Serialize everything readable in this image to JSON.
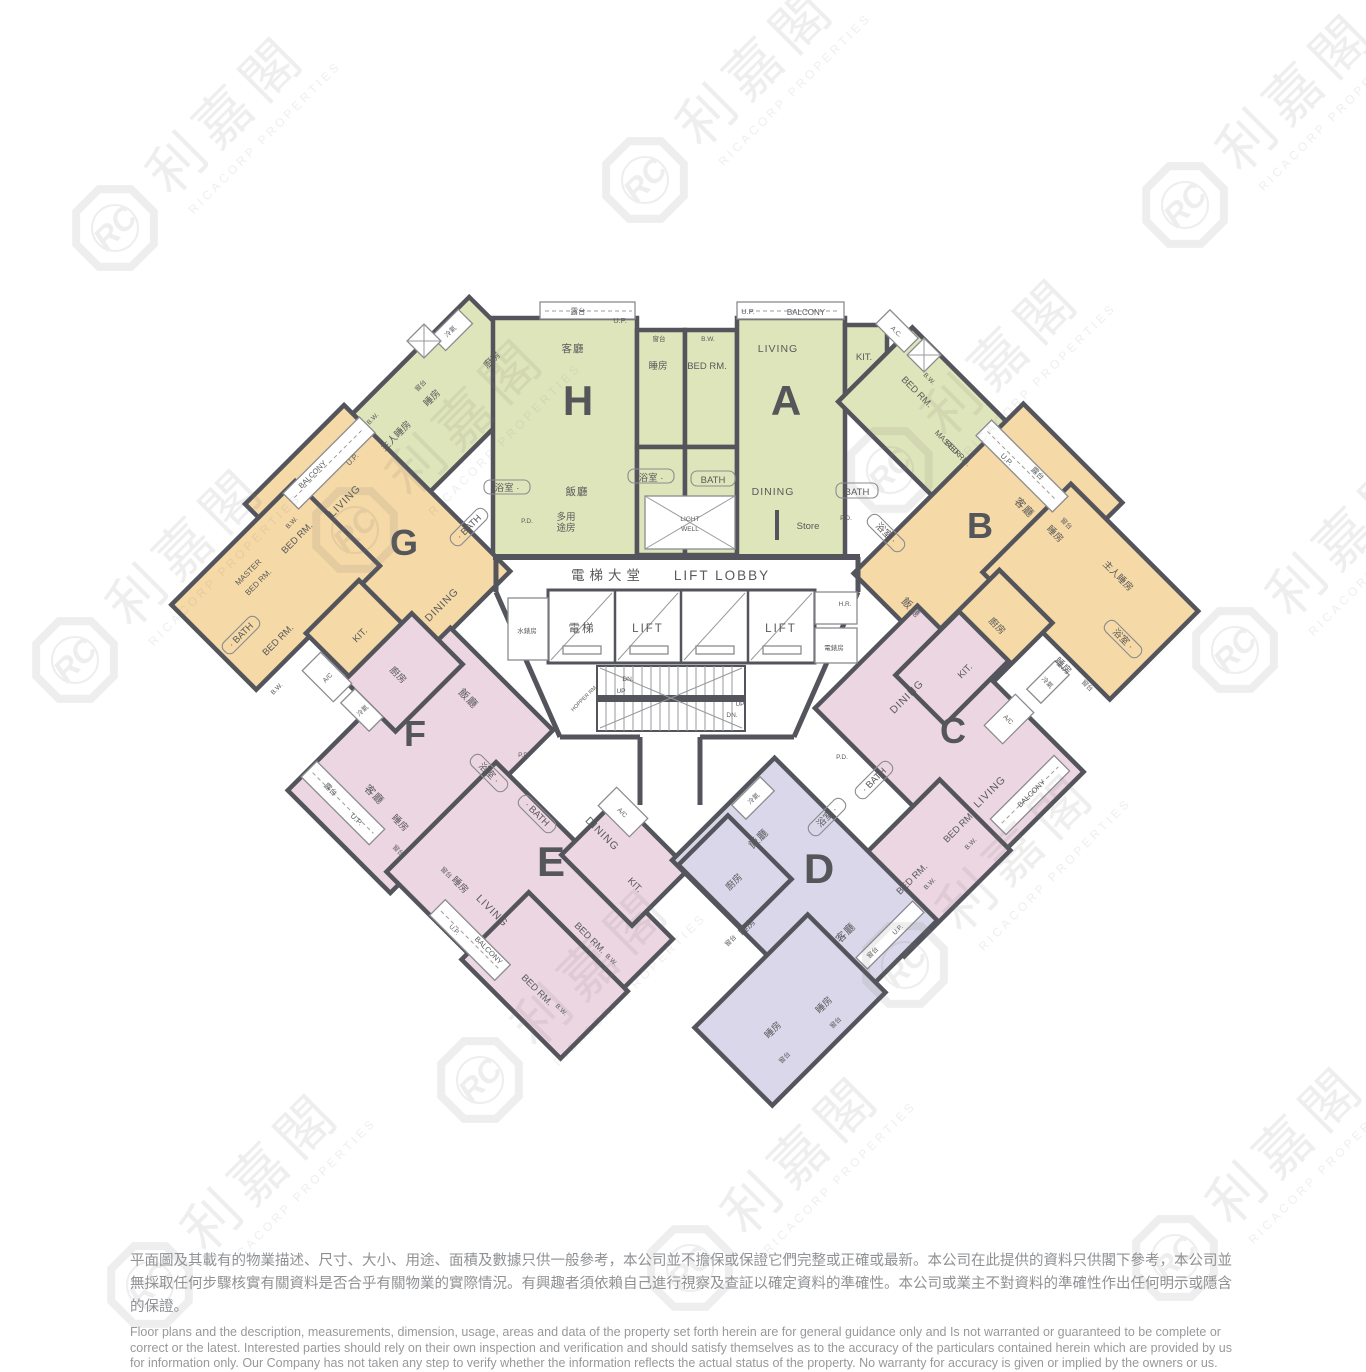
{
  "watermark": {
    "zh": "利嘉閣",
    "en": "RICACORP PROPERTIES",
    "monogram": "RC"
  },
  "units": {
    "a": "A",
    "b": "B",
    "c": "C",
    "d": "D",
    "e": "E",
    "f": "F",
    "g": "G",
    "h": "H"
  },
  "labels": {
    "balcony_zh": "露台",
    "balcony_en": "BALCONY",
    "up": "U.P.",
    "bw": "B.W.",
    "bay_zh": "窗台",
    "living_zh": "客廳",
    "living_en": "LIVING",
    "dining_zh": "飯廳",
    "dining_en": "DINING",
    "bed_zh": "睡房",
    "bed_en": "BED RM.",
    "master_zh": "主人睡房",
    "master_en1": "MASTER",
    "kitchen_zh": "廚房",
    "kit_en": "KIT.",
    "bath_zh": "浴室 ·",
    "bath_en": "· BATH",
    "bath_en2": "BATH",
    "ac": "A/C",
    "ac_dot": "A.C.",
    "aircon_zh": "冷氣",
    "multi1": "多用",
    "multi2": "途房",
    "store": "Store",
    "pd": "P.D.",
    "light": "LIGHT",
    "well": "WELL"
  },
  "lobby": {
    "hall_zh": "電梯大堂",
    "hall_en": "LIFT LOBBY",
    "lift_zh": "電梯",
    "lift_en": "LIFT",
    "water": "水錶房",
    "hr": "H.R.",
    "emeter": "電錶房",
    "hopper": "HOPPER RM.",
    "up": "UP",
    "dn": "DN."
  },
  "colors": {
    "green": "#dfe5ba",
    "orange": "#f5d9a6",
    "pink": "#ecd6e2",
    "purple": "#d9d7e9",
    "wall": "#54555c"
  },
  "disclaimer": {
    "zh": "平面圖及其載有的物業描述、尺寸、大小、用途、面積及數據只供一般參考，本公司並不擔保或保證它們完整或正確或最新。本公司在此提供的資料只供閣下參考，本公司並無採取任何步驟核實有關資料是否合乎有關物業的實際情況。有興趣者須依賴自己進行視察及查証以確定資料的準確性。本公司或業主不對資料的準確性作出任何明示或隱含的保證。",
    "en": "Floor plans and the description, measurements, dimension, usage, areas and data of the property set forth herein are for general guidance only and Is not warranted or guaranteed to be complete or correct or the latest. Interested parties should rely on their own inspection and verification and should satisfy themselves as to the accuracy of the particulars contained herein which are provided by us for information only.  Our Company has not taken any step to verify whether the information reflects the actual status of the property.  No warranty for accuracy is given or implied by the owners or us."
  }
}
